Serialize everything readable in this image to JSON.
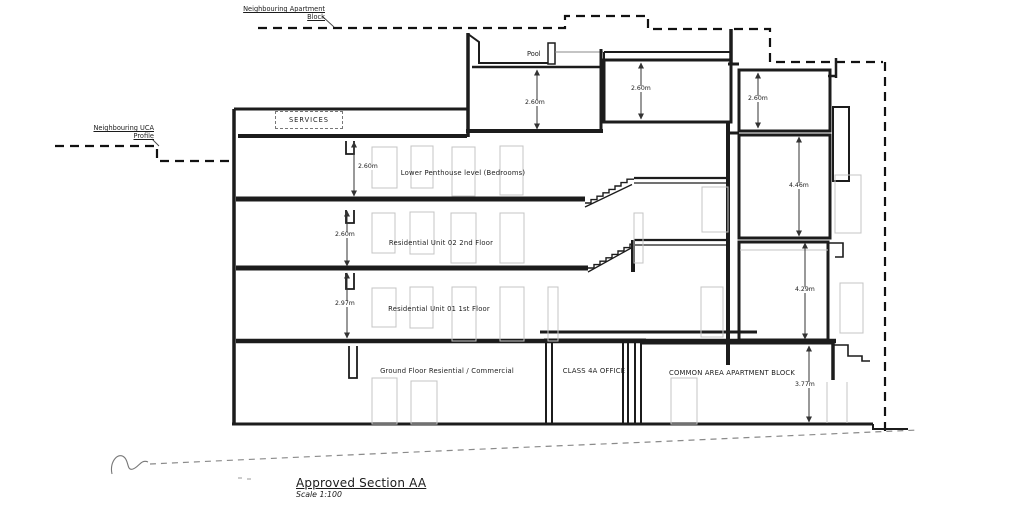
{
  "drawing": {
    "title": "Approved Section AA",
    "scale": "Scale 1:100"
  },
  "annotations": {
    "neighbour_apartment_line1": "Neighbouring Apartment",
    "neighbour_apartment_line2": "Block",
    "neighbour_uca_line1": "Neighbouring UCA",
    "neighbour_uca_line2": "Profile",
    "pool": "Pool",
    "services": "SERVICES"
  },
  "floors": {
    "penthouse": {
      "label": "Lower Penthouse level (Bedrooms)",
      "height": "2.60m"
    },
    "second": {
      "label": "Residential Unit 02 2nd Floor",
      "height": "2.60m"
    },
    "first": {
      "label": "Residential Unit 01 1st Floor",
      "height": "2.97m"
    },
    "ground": {
      "label": "Ground Floor Resiential / Commercial"
    },
    "office": {
      "label": "CLASS 4A OFFICE"
    },
    "common": {
      "label": "COMMON AREA APARTMENT BLOCK",
      "height": "3.77m"
    }
  },
  "dimensions": {
    "pool_room": "2.60m",
    "top_room_left": "2.60m",
    "top_room_right": "2.60m",
    "upper_right_room": "4.46m",
    "lower_right_room": "4.29m"
  },
  "colors": {
    "wall_line": "#1c1c1c",
    "detail_gray": "#c4c4c4",
    "ground_profile": "#8a8a8a"
  }
}
